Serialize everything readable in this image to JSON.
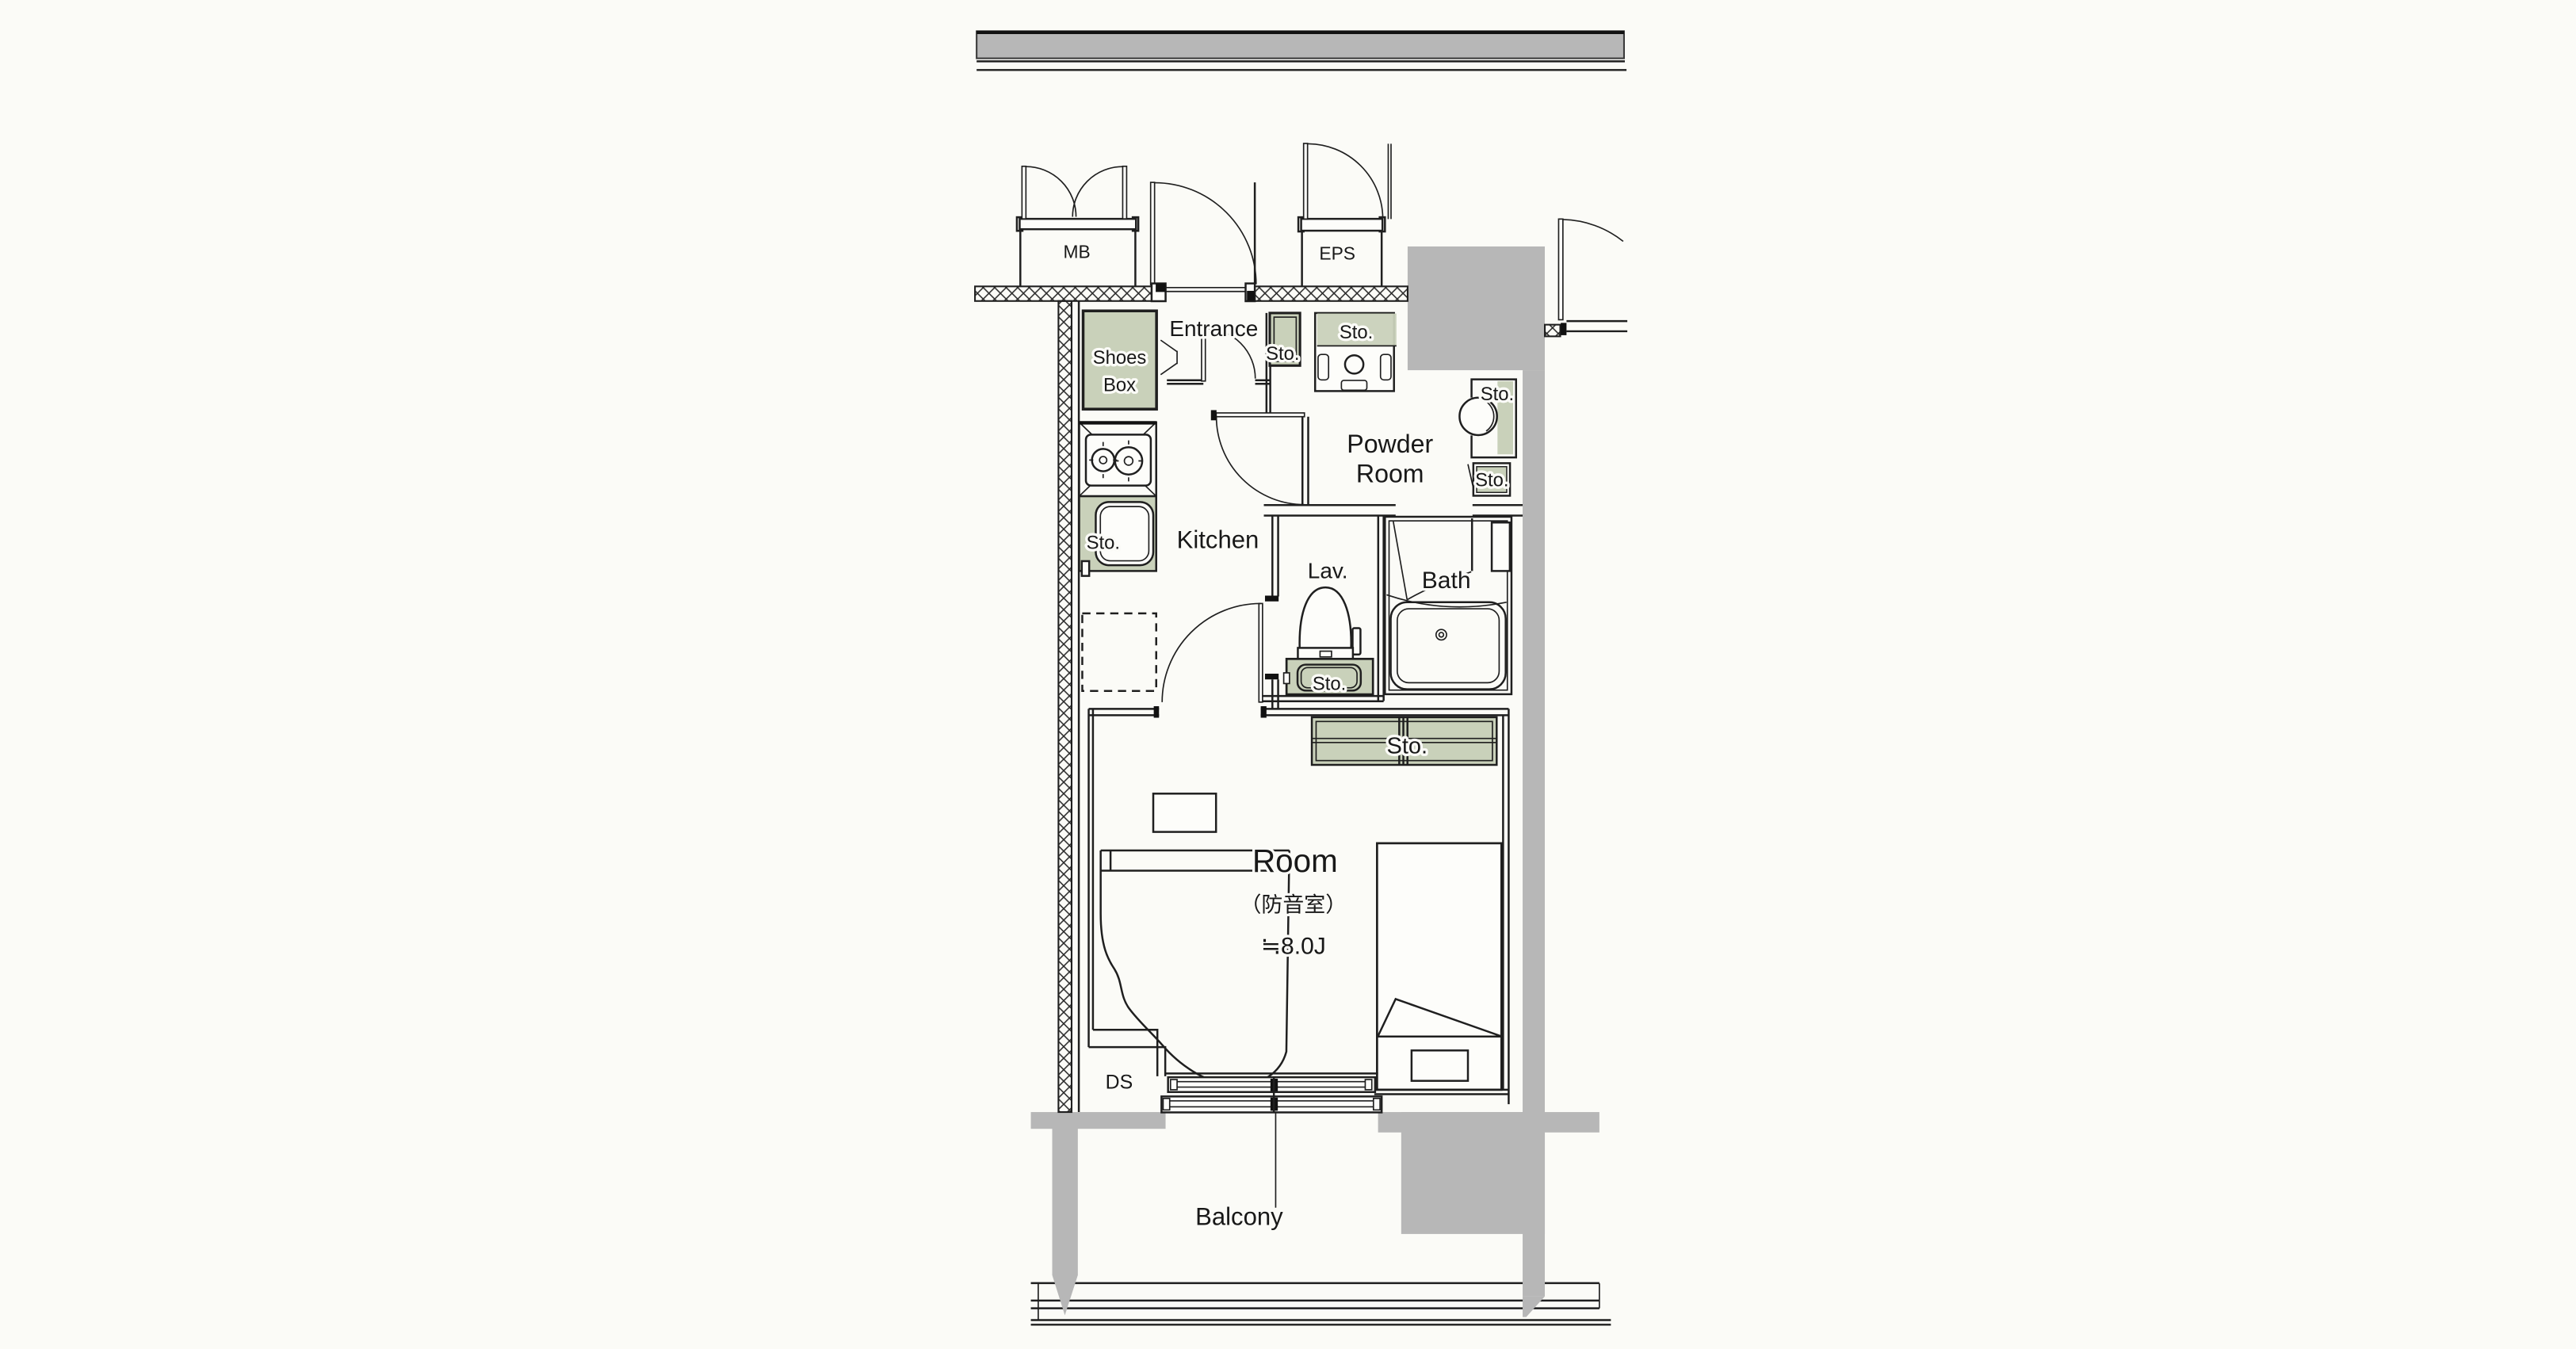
{
  "plan": {
    "labels": {
      "mb": "MB",
      "eps": "EPS",
      "entrance": "Entrance",
      "entrance_sto": "Sto.",
      "shoes1": "Shoes",
      "shoes2": "Box",
      "vanity_sto": "Sto.",
      "washer_sto": "Sto.",
      "powder_sto": "Sto.",
      "powder1": "Powder",
      "powder2": "Room",
      "kitchen": "Kitchen",
      "kitchen_sto": "Sto.",
      "lav": "Lav.",
      "lav_sto": "Sto.",
      "bath": "Bath",
      "closet_sto": "Sto.",
      "room": "Room",
      "room_note": "（防音室）",
      "room_size": "≒8.0J",
      "ds": "DS",
      "balcony": "Balcony"
    },
    "colors": {
      "storage_fill": "#c9d1ba",
      "concrete_fill": "#b7b7b7",
      "line": "#1f1f1f",
      "background": "#fbfbf7"
    }
  }
}
